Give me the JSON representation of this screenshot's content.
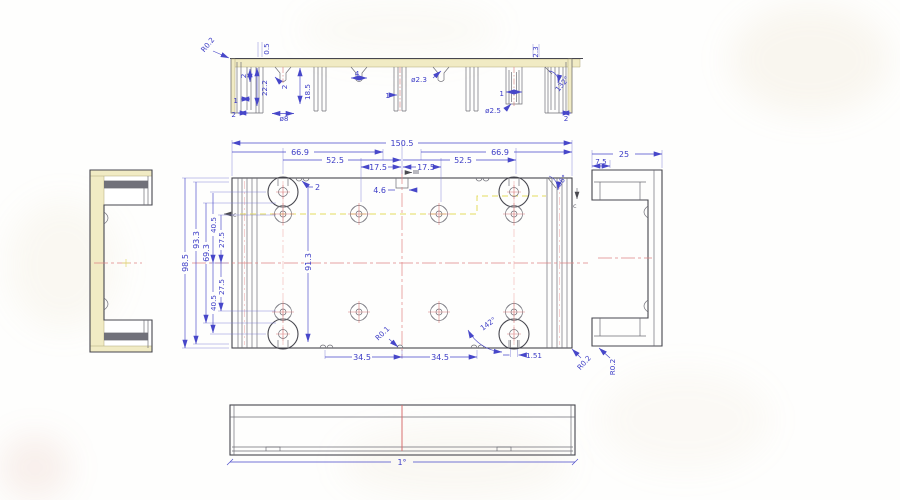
{
  "sv": {
    "r02": "R0.2",
    "d05": "0.5",
    "g2a": "2",
    "d222": "22.2",
    "g2b": "2",
    "d185": "18.5",
    "r1a": "1",
    "w2a": "2",
    "dia8": "ø8",
    "s4": "4",
    "dia23": "ø2.3",
    "r1b": "1",
    "dia25": "ø2.5",
    "r1c": "1",
    "l23": "2.3",
    "a132": "132°",
    "w2b": "2"
  },
  "pv": {
    "w1505": "150.5",
    "w669l": "66.9",
    "w669r": "66.9",
    "w525l": "52.5",
    "w525r": "52.5",
    "w175l": "17.5",
    "w175r": "17.5",
    "n2": "2",
    "s46": "4.6",
    "a36": "36°",
    "h985": "98.5",
    "h933": "93.3",
    "h693": "69.3",
    "h405t": "40.5",
    "h275t": "27.5",
    "h275b": "27.5",
    "h405b": "40.5",
    "h913": "91.3",
    "w345l": "34.5",
    "w345r": "34.5",
    "s151": "1.51",
    "r01": "R0.1",
    "a142": "142°",
    "r02": "R0.2",
    "cl": "c",
    "cr": "c"
  },
  "rv": {
    "w25": "25",
    "w75": "7.5",
    "r02": "R0.2"
  },
  "bv": {
    "a1": "1°"
  }
}
